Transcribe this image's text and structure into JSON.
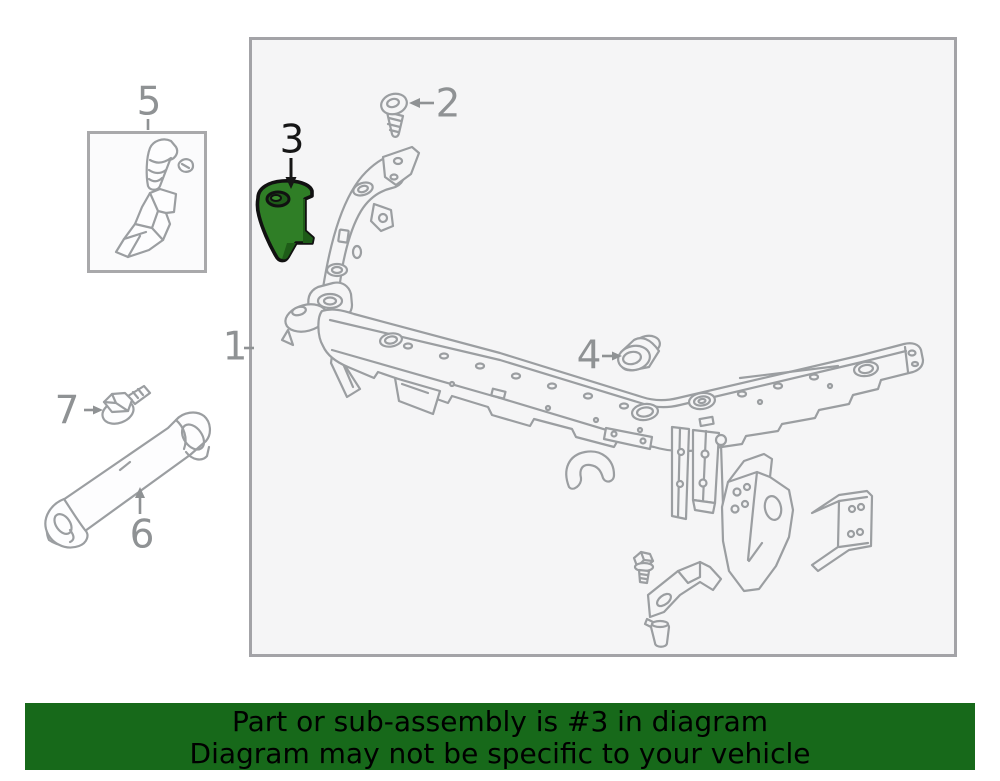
{
  "diagram": {
    "title": "radiator-support-parts-diagram",
    "box_background": "#f5f5f6",
    "line_color": "#9b9ea1",
    "label_color": "#8f9294",
    "highlight_color": "#2f7e26",
    "highlighted_callout": "3",
    "callouts": [
      {
        "id": "1",
        "label": "1",
        "part": "radiator-support-assembly"
      },
      {
        "id": "2",
        "label": "2",
        "part": "screw"
      },
      {
        "id": "3",
        "label": "3",
        "part": "highlighted-bracket"
      },
      {
        "id": "4",
        "label": "4",
        "part": "grommet-bushing"
      },
      {
        "id": "5",
        "label": "5",
        "part": "side-bracket-set"
      },
      {
        "id": "6",
        "label": "6",
        "part": "diagonal-brace-tube"
      },
      {
        "id": "7",
        "label": "7",
        "part": "flange-bolt"
      }
    ]
  },
  "banner": {
    "line1": "Part or sub-assembly is #3 in diagram",
    "line2": "Diagram may not be specific to your vehicle",
    "background_color": "#17691a",
    "text_color": "#000000"
  }
}
